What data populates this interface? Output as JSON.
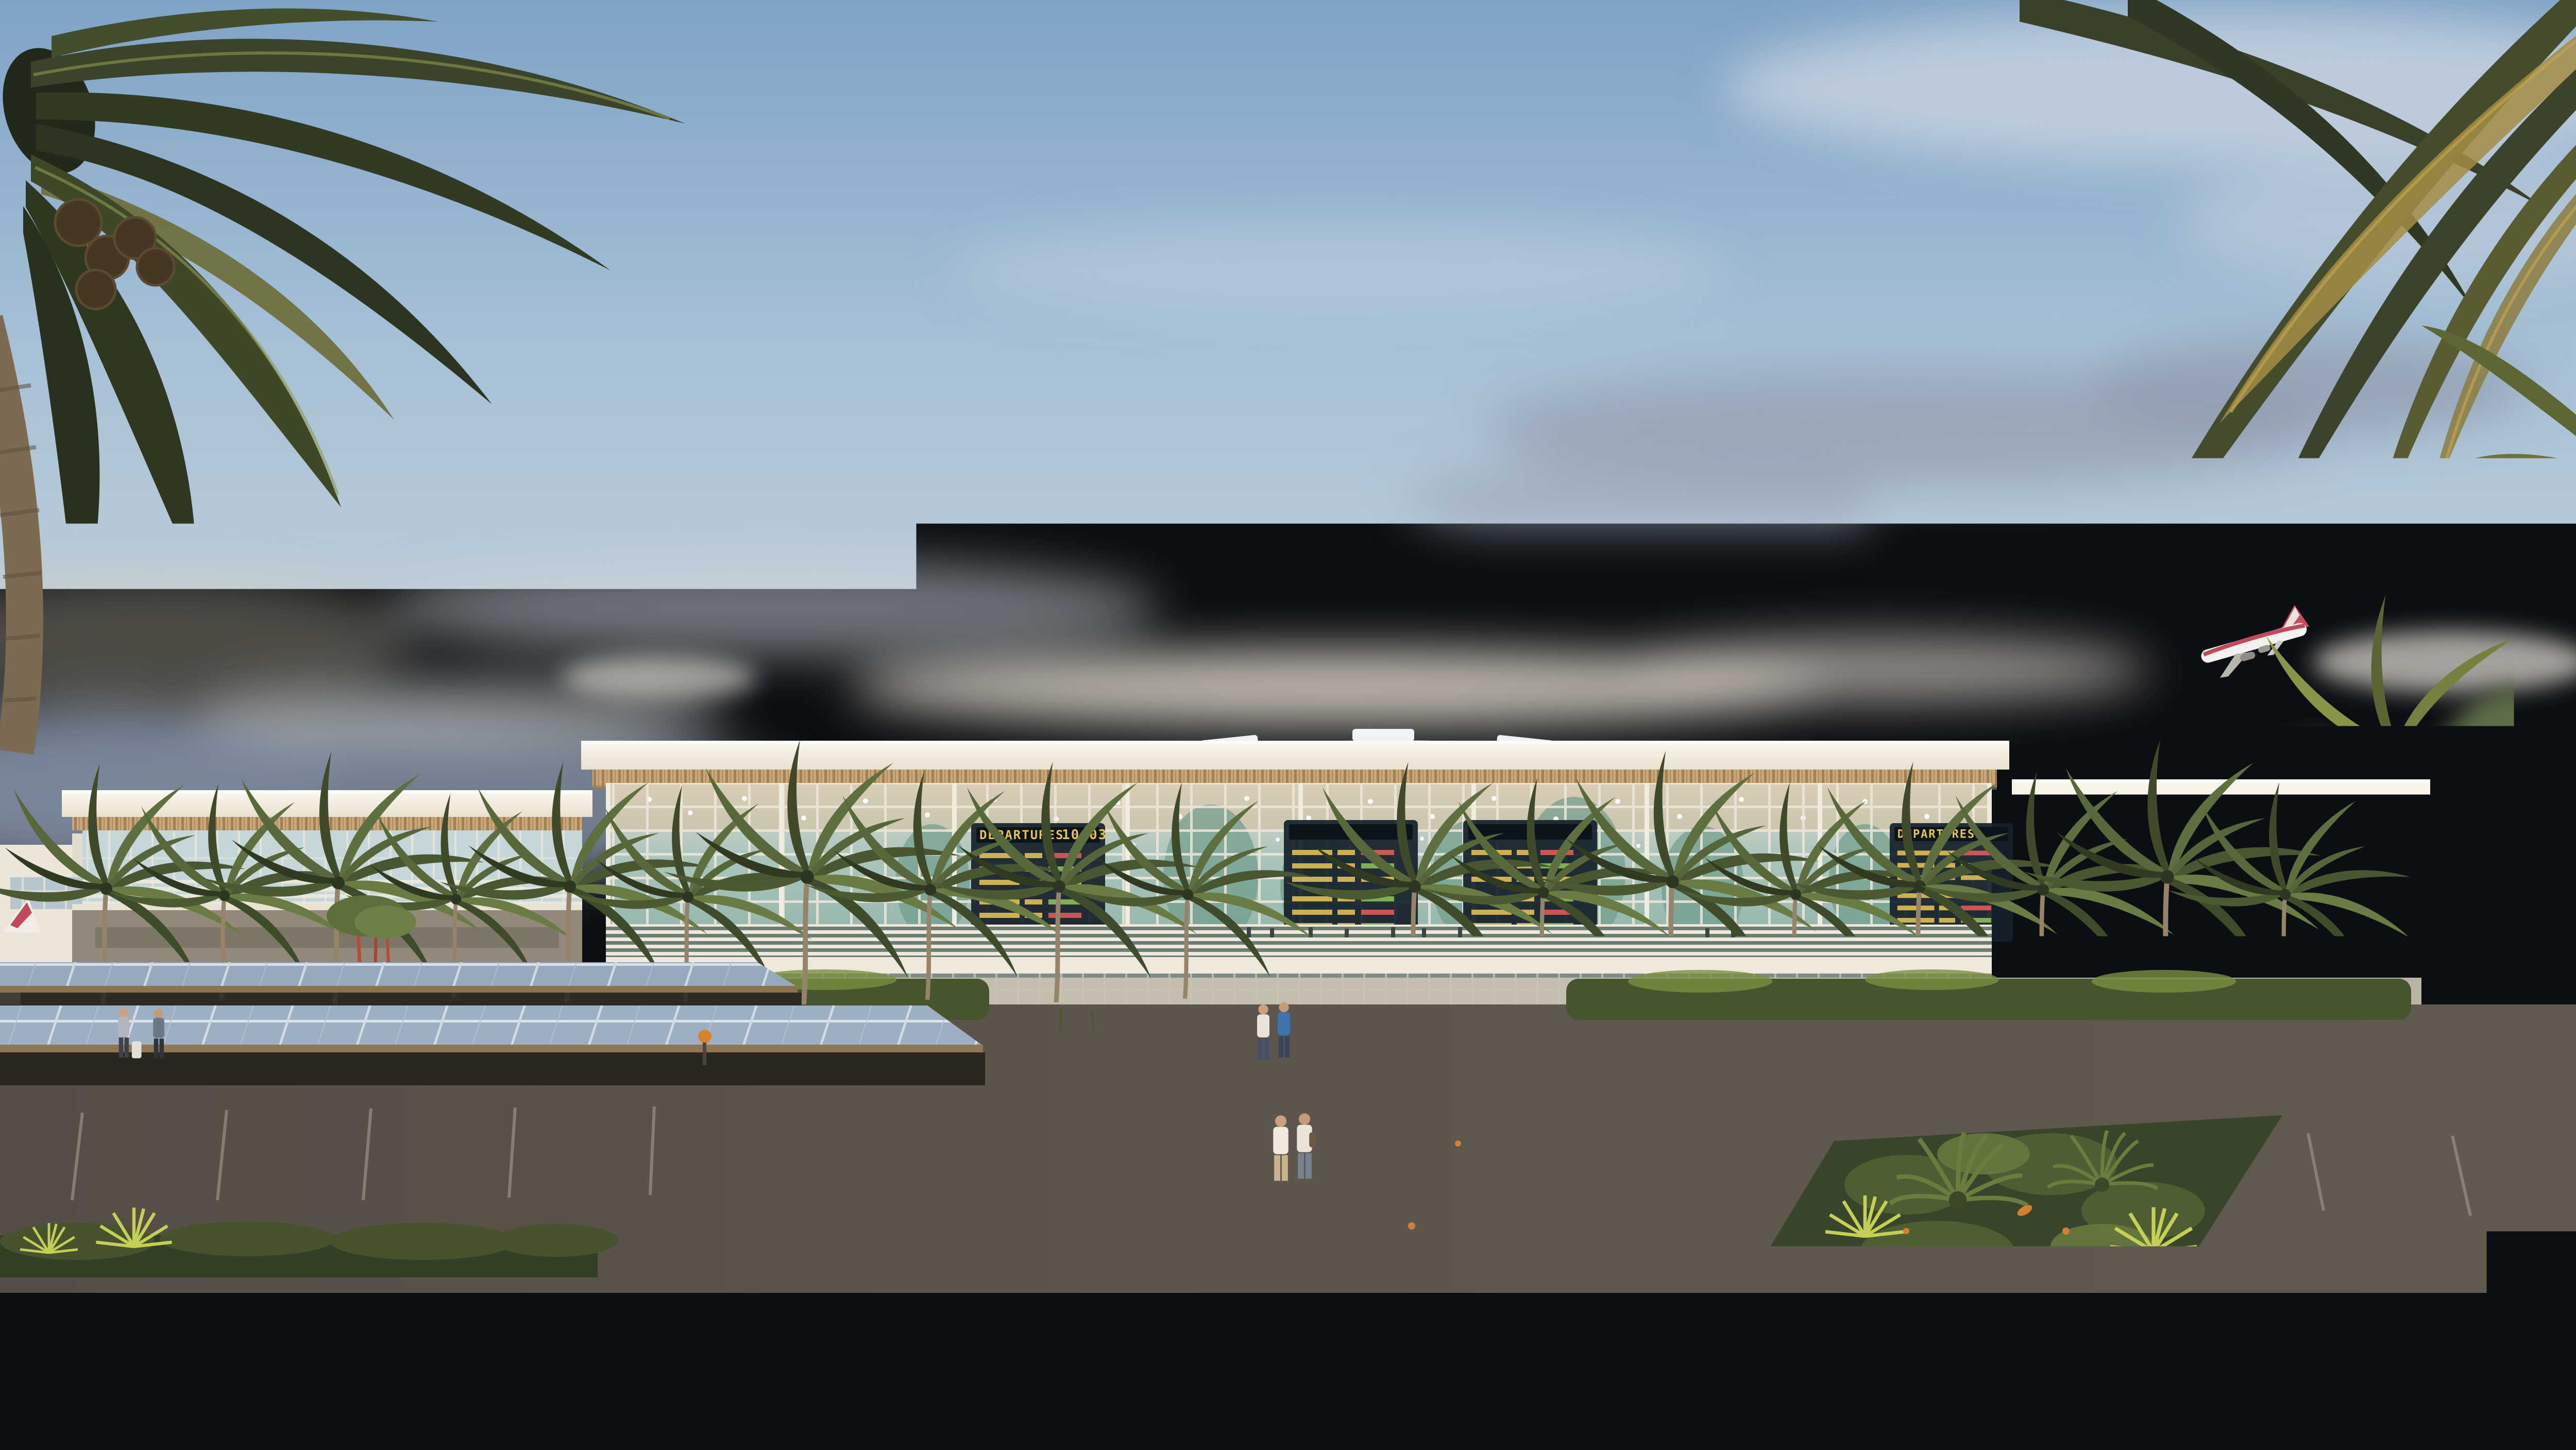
{
  "scene": {
    "type": "architectural-rendering",
    "setting": "tropical airport terminal exterior at golden hour",
    "weather": "soft clouds, warm low sun from the left",
    "foreground": "asphalt access road with zebra crosswalk, kerb, flowering shrubs",
    "midground": "solar-panel carport canopies over parking rows, bougainvillea pergola over central paved walkway, tropical median planters",
    "background": "long white terminal with ribbed roof dome, timber-slat roof soffit, glass curtain wall, rows of palms",
    "sky_features": [
      "coconut palm fronds framing the top corners",
      "airliner climbing after takeoff at upper right"
    ]
  },
  "terminal": {
    "departures_label": "DEPARTURES",
    "board_time": "10:03",
    "board_statuses_visible": [
      "ON TIME",
      "DELAYED",
      "GATE CLOSING"
    ],
    "facade": "glass curtain wall with cream mullions and teal reflections",
    "roof": "white fascia, timber-slat soffit, ribbed central dome with skylights"
  },
  "airplane": {
    "livery": "white fuselage, red tail and red cheatline",
    "phase": "climbing to the right"
  },
  "parking": {
    "canopy": "photovoltaic panels on dark steel frames",
    "approx_visible_cars": 38
  },
  "people": {
    "approx_count": 10,
    "notes": [
      "group of three travellers with a white suitcase in left lot",
      "two pairs walking the central walkway",
      "traveller with luggage beside white SUV at right"
    ]
  },
  "palette": {
    "sky_top": "#86a8c9",
    "sky_mid": "#b3c8d8",
    "sky_horizon": "#ddd2c2",
    "cloud_grey": "#96a1b3",
    "roof_white": "#f6f1e7",
    "timber_slat": "#c9a97c",
    "glass_teal": "#8fb3a8",
    "mullion": "#ece7da",
    "board_bg": "#15212b",
    "board_amber": "#e5c34c",
    "status_green": "#7fae54",
    "status_red": "#cc5555",
    "solar_panel": "#97a9bd",
    "asphalt": "#4a443c",
    "crosswalk": "#d2c4b0",
    "paver": "#b9a383",
    "foliage_dark": "#2e3821",
    "foliage_light": "#71854a",
    "bougainvillea": "#c45a9a",
    "accent_orange": "#d8822e",
    "car_white": "#e9e6df",
    "trunk_brown": "#7b6b52"
  }
}
